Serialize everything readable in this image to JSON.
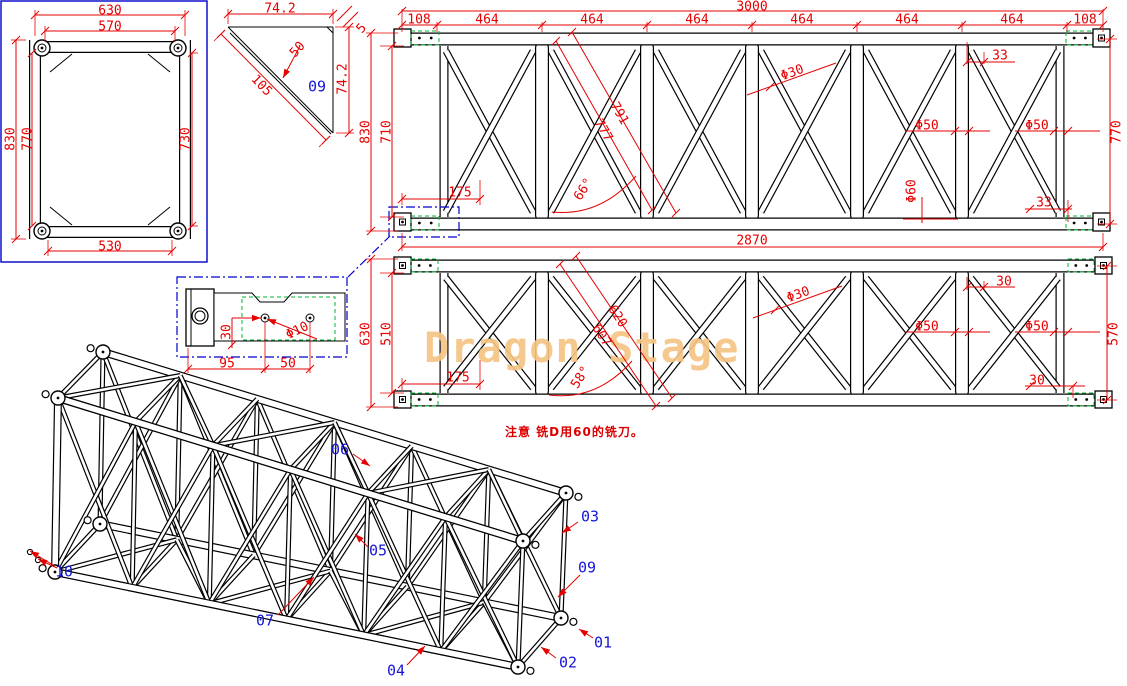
{
  "watermark": {
    "text": "Dragon Stage",
    "color": "#f5c584"
  },
  "note": {
    "text": "注意 铣D用60的铣刀。",
    "color": "#dd0000"
  },
  "colors": {
    "dim": "#e60000",
    "part": "#1515d9",
    "geometry": "#000000",
    "plate": "#00b432",
    "viewport": "#0000cc"
  },
  "views": {
    "end_view": {
      "labels": [
        {
          "t": "630",
          "x": 110,
          "y": 10
        },
        {
          "t": "570",
          "x": 110,
          "y": 26
        },
        {
          "t": "830",
          "x": 10,
          "y": 139,
          "r": -90
        },
        {
          "t": "770",
          "x": 27,
          "y": 139,
          "r": -90
        },
        {
          "t": "730",
          "x": 185,
          "y": 139,
          "r": -90
        },
        {
          "t": "530",
          "x": 110,
          "y": 246
        }
      ]
    },
    "gusset_view": {
      "labels": [
        {
          "t": "74.2",
          "x": 280,
          "y": 8
        },
        {
          "t": "5",
          "x": 361,
          "y": 28,
          "r": -48
        },
        {
          "t": "50",
          "x": 297,
          "y": 49,
          "r": -48
        },
        {
          "t": "105",
          "x": 262,
          "y": 85,
          "r": 46
        },
        {
          "t": "74.2",
          "x": 342,
          "y": 79,
          "r": -90
        },
        {
          "t": "09",
          "x": 317,
          "y": 87,
          "c": "part"
        }
      ]
    },
    "truss_side_top": {
      "labels": [
        {
          "t": "3000",
          "x": 752,
          "y": 6
        },
        {
          "t": "108",
          "x": 419,
          "y": 19
        },
        {
          "t": "464",
          "x": 487,
          "y": 19
        },
        {
          "t": "464",
          "x": 592,
          "y": 19
        },
        {
          "t": "464",
          "x": 697,
          "y": 19
        },
        {
          "t": "464",
          "x": 802,
          "y": 19
        },
        {
          "t": "464",
          "x": 907,
          "y": 19
        },
        {
          "t": "464",
          "x": 1012,
          "y": 19
        },
        {
          "t": "108",
          "x": 1085,
          "y": 19
        },
        {
          "t": "830",
          "x": 365,
          "y": 132,
          "r": -90
        },
        {
          "t": "710",
          "x": 386,
          "y": 132,
          "r": -90
        },
        {
          "t": "770",
          "x": 1116,
          "y": 132,
          "r": -90
        },
        {
          "t": "33",
          "x": 1000,
          "y": 55
        },
        {
          "t": "Φ30",
          "x": 792,
          "y": 72,
          "r": -20
        },
        {
          "t": "791",
          "x": 620,
          "y": 113,
          "r": 60
        },
        {
          "t": "777",
          "x": 604,
          "y": 130,
          "r": 60
        },
        {
          "t": "66°",
          "x": 583,
          "y": 189,
          "r": -57
        },
        {
          "t": "175",
          "x": 460,
          "y": 192
        },
        {
          "t": "Φ50",
          "x": 927,
          "y": 125
        },
        {
          "t": "Φ50",
          "x": 1037,
          "y": 125
        },
        {
          "t": "Φ60",
          "x": 911,
          "y": 191,
          "r": -90
        },
        {
          "t": "33",
          "x": 1044,
          "y": 202
        },
        {
          "t": "2870",
          "x": 752,
          "y": 240
        }
      ]
    },
    "truss_side_bottom": {
      "labels": [
        {
          "t": "630",
          "x": 365,
          "y": 334,
          "r": -90
        },
        {
          "t": "510",
          "x": 386,
          "y": 334,
          "r": -90
        },
        {
          "t": "570",
          "x": 1113,
          "y": 334,
          "r": -90
        },
        {
          "t": "175",
          "x": 458,
          "y": 377
        },
        {
          "t": "Φ30",
          "x": 798,
          "y": 294,
          "r": -20
        },
        {
          "t": "620",
          "x": 618,
          "y": 316,
          "r": 57
        },
        {
          "t": "607",
          "x": 602,
          "y": 335,
          "r": 57
        },
        {
          "t": "58°",
          "x": 580,
          "y": 377,
          "r": -57
        },
        {
          "t": "Φ50",
          "x": 927,
          "y": 326
        },
        {
          "t": "Φ50",
          "x": 1037,
          "y": 326
        },
        {
          "t": "30",
          "x": 1004,
          "y": 281
        },
        {
          "t": "30",
          "x": 1037,
          "y": 380
        }
      ]
    },
    "connector_detail": {
      "labels": [
        {
          "t": "30",
          "x": 226,
          "y": 332,
          "r": -90
        },
        {
          "t": "95",
          "x": 227,
          "y": 363
        },
        {
          "t": "50",
          "x": 288,
          "y": 363
        },
        {
          "t": "Φ10",
          "x": 297,
          "y": 330,
          "r": -26
        }
      ]
    },
    "iso_view": {
      "part_labels": [
        {
          "t": "10",
          "x": 64,
          "y": 572,
          "leaders": [
            [
              53,
              565,
              30,
              551
            ],
            [
              57,
              568,
              38,
              559
            ]
          ]
        },
        {
          "t": "06",
          "x": 340,
          "y": 450,
          "leaders": [
            [
              353,
              454,
              370,
              466
            ]
          ]
        },
        {
          "t": "05",
          "x": 378,
          "y": 551,
          "leaders": [
            [
              368,
              547,
              355,
              534
            ]
          ]
        },
        {
          "t": "07",
          "x": 265,
          "y": 621,
          "leaders": [
            [
              278,
              615,
              314,
              577
            ]
          ]
        },
        {
          "t": "04",
          "x": 396,
          "y": 671,
          "leaders": [
            [
              407,
              665,
              425,
              646
            ]
          ]
        },
        {
          "t": "02",
          "x": 568,
          "y": 663,
          "leaders": [
            [
              556,
              658,
              541,
              647
            ]
          ]
        },
        {
          "t": "01",
          "x": 603,
          "y": 643,
          "leaders": [
            [
              593,
              638,
              579,
              629
            ]
          ]
        },
        {
          "t": "09",
          "x": 587,
          "y": 568,
          "leaders": [
            [
              580,
              575,
              558,
              597
            ]
          ]
        },
        {
          "t": "03",
          "x": 590,
          "y": 517,
          "leaders": [
            [
              578,
              522,
              562,
              533
            ]
          ]
        }
      ]
    }
  }
}
